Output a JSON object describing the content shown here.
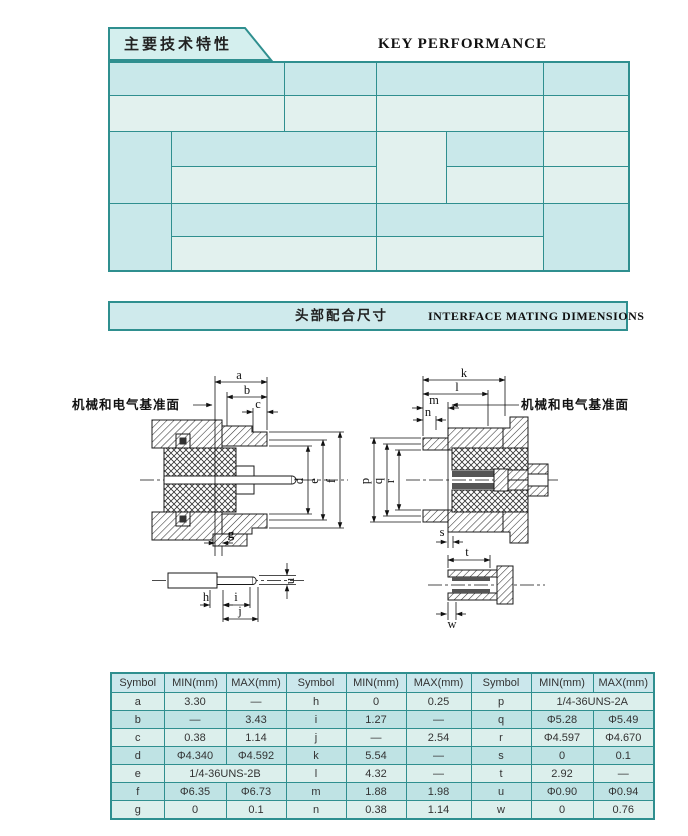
{
  "colors": {
    "teal_border": "#2f8f8f",
    "cell_cyan": "#c9e8ea",
    "cell_light": "#e2f1ee",
    "tab_fill": "#d4efee",
    "table_header": "#cbe7ec"
  },
  "key_performance": {
    "tab_title": "主要技术特性",
    "title": "KEY PERFORMANCE",
    "temperature": {
      "zh": "温度范围",
      "en": "Temperature range",
      "value": "-65~+165℃"
    },
    "impedance": {
      "zh": "特性阻抗",
      "en": "Characteristic Impedance",
      "value": "50 Ω"
    },
    "insulation": {
      "zh": "绝缘电阻",
      "en": "Insulation resistance",
      "value": "≥5000MΩ"
    },
    "dielectric": {
      "zh": "介质耐压",
      "en": "DielectricWithstanding voltage",
      "value": "1000V"
    },
    "frequency": {
      "zh": "频率范围",
      "en": "Frequency range",
      "flexible": {
        "zh": "配软电缆",
        "en": "With flexible cable",
        "value": "0~12.4GHz"
      },
      "semirigid": {
        "zh": "配半刚、半柔性电缆",
        "en": "With semi-rigid/flexible cable",
        "value": "0~18GHz"
      }
    },
    "contact": {
      "zh": "接触电阻",
      "en": "Contact resistance",
      "center": {
        "zh": "中心导体",
        "en": "Center conductor",
        "value": "≤0.003  Ω"
      },
      "outer": {
        "zh": "外导体",
        "en": "Outer conductor",
        "value": "≤0.002  Ω"
      }
    },
    "vswr": {
      "zh": "电压驻波比",
      "en": "VSWR",
      "flexible": {
        "zh": "配软电缆",
        "en": "With flexible cable",
        "value": "≤1.15+ 0.02F"
      },
      "semirigid": {
        "zh": "配半刚、半柔性电缆",
        "en": "With semi-rigid/flexible cable",
        "value": "≤1.10+ 0.02F"
      }
    },
    "durability": {
      "zh": "寿　命",
      "en": "Durability",
      "value": "500Cycles"
    }
  },
  "interface_heading": {
    "zh": "头部配合尺寸",
    "en": "INTERFACE MATING DIMENSIONS"
  },
  "drawings": {
    "datum_label": "机械和电气基准面",
    "left_top": [
      "a",
      "b",
      "c"
    ],
    "left_right": [
      "d",
      "e",
      "f"
    ],
    "left_bottom": [
      "g"
    ],
    "pin_dims": [
      "h",
      "i",
      "j",
      "u"
    ],
    "right_top": [
      "k",
      "l",
      "m",
      "n"
    ],
    "right_left": [
      "p",
      "q",
      "r"
    ],
    "right_bottom": [
      "s"
    ],
    "socket_dims": [
      "t",
      "w"
    ]
  },
  "dim_table": {
    "headers": [
      "Symbol",
      "MIN(mm)",
      "MAX(mm)",
      "Symbol",
      "MIN(mm)",
      "MAX(mm)",
      "Symbol",
      "MIN(mm)",
      "MAX(mm)"
    ],
    "rows": [
      [
        "a",
        "3.30",
        "—",
        "h",
        "0",
        "0.25",
        "p",
        {
          "v": "1/4-36UNS-2A",
          "span": 2
        }
      ],
      [
        "b",
        "—",
        "3.43",
        "i",
        "1.27",
        "—",
        "q",
        "Φ5.28",
        "Φ5.49"
      ],
      [
        "c",
        "0.38",
        "1.14",
        "j",
        "—",
        "2.54",
        "r",
        "Φ4.597",
        "Φ4.670"
      ],
      [
        "d",
        "Φ4.340",
        "Φ4.592",
        "k",
        "5.54",
        "—",
        "s",
        "0",
        "0.1"
      ],
      [
        "e",
        {
          "v": "1/4-36UNS-2B",
          "span": 2
        },
        "l",
        "4.32",
        "—",
        "t",
        "2.92",
        "—"
      ],
      [
        "f",
        "Φ6.35",
        "Φ6.73",
        "m",
        "1.88",
        "1.98",
        "u",
        "Φ0.90",
        "Φ0.94"
      ],
      [
        "g",
        "0",
        "0.1",
        "n",
        "0.38",
        "1.14",
        "w",
        "0",
        "0.76"
      ]
    ]
  }
}
